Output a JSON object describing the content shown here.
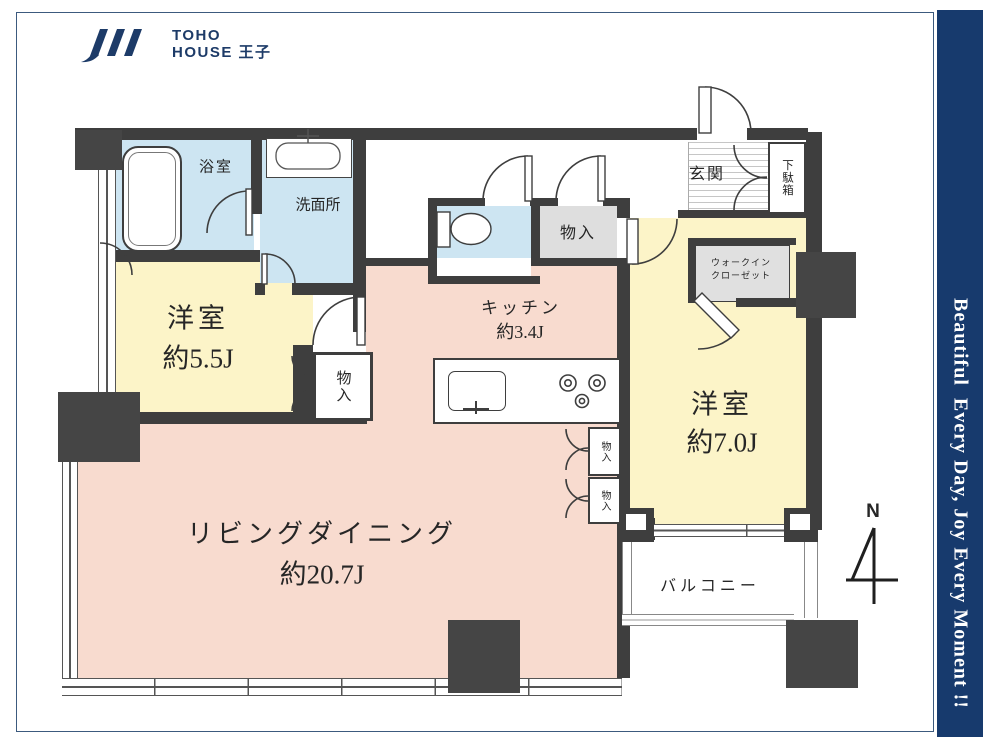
{
  "logo": {
    "line1": "TOHO",
    "line2": "HOUSE 王子"
  },
  "side_banner": {
    "text": "Beautiful  Every Day, Joy Every Moment !!"
  },
  "compass": {
    "north_label": "N"
  },
  "rooms": {
    "bath": {
      "label": "浴室"
    },
    "washroom": {
      "label": "洗面所"
    },
    "hall_storage": {
      "label": "物入"
    },
    "bedroom1": {
      "name": "洋室",
      "size": "約5.5J",
      "storage_label": "物入"
    },
    "kitchen": {
      "name": "キッチン",
      "size": "約3.4J"
    },
    "entrance": {
      "label": "玄関"
    },
    "shoe_cabinet": {
      "label": "下駄箱"
    },
    "walk_in_closet": {
      "line1": "ウォークイン",
      "line2": "クローゼット"
    },
    "bedroom2": {
      "name": "洋室",
      "size": "約7.0J"
    },
    "living_dining": {
      "name": "リビングダイニング",
      "size": "約20.7J"
    },
    "living_storage_upper": {
      "label": "物入"
    },
    "living_storage_lower": {
      "label": "物入"
    },
    "balcony": {
      "label": "バルコニー"
    }
  },
  "colors": {
    "banner_navy": "#173a6d",
    "logo_navy": "#1d3b68",
    "wall": "#3e3e3e",
    "room_yellow": "#fcf4c8",
    "room_pink": "#f8dbcf",
    "room_blue": "#cde5f2",
    "storage_gray": "#dedede",
    "frame_line": "#3c5a7e"
  }
}
